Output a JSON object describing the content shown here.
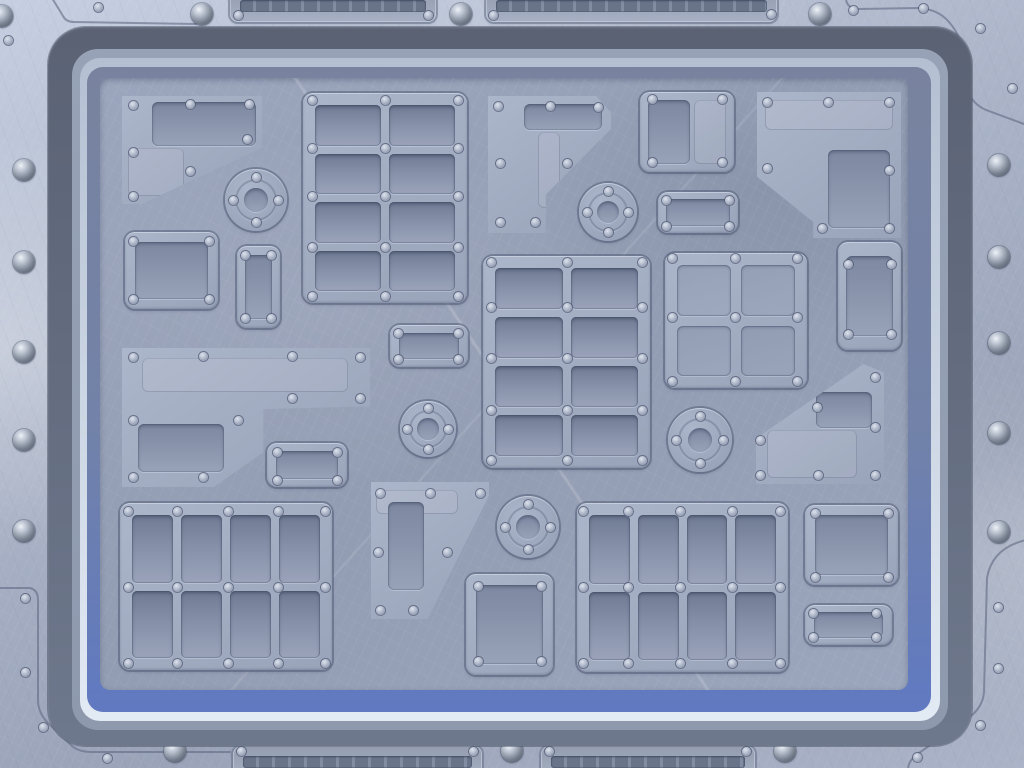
{
  "meta": {
    "description": "Sci-fi brushed-metal tech panel background: outer riveted steel frame with vent grilles and dome bolts, layered blue border rings, inner hull covered with riveted plates, vent grids and circular access ports",
    "width": 1024,
    "height": 768,
    "visible_text": "none"
  },
  "colors": {
    "metal_a": "#c6cfe1",
    "metal_b": "#aab3c7",
    "metal_c": "#9aa3b8",
    "ring_dark_a": "#5a6274",
    "ring_dark_b": "#6e788c",
    "ring_mid": "#8e99ae",
    "ring_light_a": "#b4c0d2",
    "ring_light_b": "#e2eaf4",
    "ring_blue_a": "#79839f",
    "ring_blue_b": "#6079c1",
    "panel_a": "#9ba5bc",
    "panel_b": "#929cb2",
    "plate_a": "#acb6ca",
    "plate_b": "#99a3b9",
    "inset_a": "#7d88a1",
    "inset_b": "#98a2b8",
    "cell_a": "#6f7a93",
    "cell_b": "#9aa3ba",
    "slat_a": "#6a7489",
    "slat_b": "#828da2",
    "rivet_a": "#dde4ee",
    "rivet_b": "#a6afc2",
    "rivet_c": "#7c869d",
    "rivet_edge": "rgba(80,90,115,0.75)",
    "dome_a": "#eef2f7",
    "dome_b": "#b9c1cf",
    "dome_c": "#78818f",
    "dome_d": "#565e6d",
    "line_dark": "rgba(86,96,122,0.55)",
    "line_light": "rgba(228,236,248,0.5)",
    "seam": "rgba(95,105,130,0.6)"
  },
  "scene": {
    "frame": {
      "domes": [
        [
          2,
          16
        ],
        [
          24,
          170
        ],
        [
          24,
          262
        ],
        [
          24,
          352
        ],
        [
          24,
          440
        ],
        [
          24,
          531
        ],
        [
          999,
          165
        ],
        [
          999,
          257
        ],
        [
          999,
          343
        ],
        [
          999,
          433
        ],
        [
          999,
          532
        ],
        [
          202,
          14
        ],
        [
          461,
          14
        ],
        [
          820,
          14
        ],
        [
          175,
          751
        ],
        [
          512,
          751
        ],
        [
          785,
          751
        ]
      ],
      "rivets": [
        [
          8,
          40
        ],
        [
          98,
          7
        ],
        [
          238,
          15
        ],
        [
          428,
          15
        ],
        [
          493,
          15
        ],
        [
          771,
          14
        ],
        [
          853,
          10
        ],
        [
          923,
          8
        ],
        [
          980,
          28
        ],
        [
          1012,
          88
        ],
        [
          25,
          598
        ],
        [
          25,
          672
        ],
        [
          43,
          727
        ],
        [
          107,
          758
        ],
        [
          241,
          751
        ],
        [
          473,
          751
        ],
        [
          549,
          751
        ],
        [
          746,
          751
        ],
        [
          998,
          607
        ],
        [
          998,
          668
        ],
        [
          980,
          725
        ],
        [
          917,
          757
        ]
      ],
      "grilles": [
        {
          "x": 230,
          "y": -10,
          "w": 206
        },
        {
          "x": 486,
          "y": -10,
          "w": 291
        },
        {
          "x": 233,
          "y": 746,
          "w": 249
        },
        {
          "x": 541,
          "y": 746,
          "w": 214
        }
      ],
      "seams": [
        "M 52 -2 L 63 16 Q 66 22 74 22 L 196 24",
        "M 846 -2 Q 846 8 858 9 L 918 8 Q 938 9 949 22 Q 962 37 964 56 L 966 82 Q 968 102 986 110 L 1024 124",
        "M -2 588 L 30 588 Q 38 590 38 600 L 38 700 Q 38 712 47 722 L 72 746 Q 79 752 92 752 L 230 752",
        "M 1026 540 Q 992 548 987 578 L 984 692 Q 983 706 971 716 L 919 753 Q 908 760 908 770"
      ]
    },
    "panel": {
      "plates": [
        {
          "name": "plate-top-left-angled",
          "x": 122,
          "y": 96,
          "w": 140,
          "h": 108,
          "clip": "polygon(0% 0%,100% 0%,100% 48%,14% 100%,0% 100%)",
          "kids": [
            {
              "t": "inset",
              "x": 30,
              "y": 6,
              "w": 104,
              "h": 44
            },
            {
              "t": "etch",
              "x": 6,
              "y": 52,
              "w": 56,
              "h": 48
            }
          ]
        },
        {
          "name": "plate-square-left",
          "x": 125,
          "y": 232,
          "w": 93,
          "h": 77,
          "kids": [
            {
              "t": "inset",
              "x": 10,
              "y": 10,
              "w": 73,
              "h": 57
            }
          ]
        },
        {
          "name": "plate-tall-small",
          "x": 237,
          "y": 246,
          "w": 43,
          "h": 82,
          "kids": [
            {
              "t": "inset",
              "x": 8,
              "y": 9,
              "w": 27,
              "h": 64
            }
          ]
        },
        {
          "name": "plate-l-shaped-left",
          "x": 122,
          "y": 348,
          "w": 248,
          "h": 139,
          "clip": "polygon(0% 0%,100% 0%,100% 42%,57% 44%,57% 75%,37% 100%,0% 100%)",
          "kids": [
            {
              "t": "etch",
              "x": 20,
              "y": 10,
              "w": 206,
              "h": 34
            },
            {
              "t": "inset",
              "x": 16,
              "y": 76,
              "w": 86,
              "h": 48
            }
          ]
        },
        {
          "name": "plate-small-wide-left",
          "x": 267,
          "y": 443,
          "w": 80,
          "h": 44,
          "kids": [
            {
              "t": "inset",
              "x": 9,
              "y": 8,
              "w": 62,
              "h": 28
            }
          ]
        },
        {
          "name": "plate-small-wide-center",
          "x": 390,
          "y": 325,
          "w": 78,
          "h": 42,
          "kids": [
            {
              "t": "inset",
              "x": 9,
              "y": 8,
              "w": 60,
              "h": 26
            }
          ]
        },
        {
          "name": "plate-pentagon-center",
          "x": 371,
          "y": 482,
          "w": 118,
          "h": 137,
          "clip": "polygon(0% 0%,100% 0%,100% 10%,48% 100%,0% 100%)",
          "kids": [
            {
              "t": "etch",
              "x": 5,
              "y": 8,
              "w": 82,
              "h": 24
            },
            {
              "t": "inset",
              "x": 17,
              "y": 20,
              "w": 36,
              "h": 88
            }
          ]
        },
        {
          "name": "plate-square-bottom-center",
          "x": 466,
          "y": 574,
          "w": 87,
          "h": 101,
          "kids": [
            {
              "t": "inset",
              "x": 10,
              "y": 11,
              "w": 67,
              "h": 79
            }
          ]
        },
        {
          "name": "plate-flag-top-center",
          "x": 488,
          "y": 96,
          "w": 123,
          "h": 137,
          "clip": "polygon(0% 0%,88% 0%,100% 12%,100% 24%,47% 72%,47% 100%,0% 100%)",
          "kids": [
            {
              "t": "inset",
              "x": 36,
              "y": 8,
              "w": 78,
              "h": 26
            },
            {
              "t": "etch",
              "x": 50,
              "y": 36,
              "w": 22,
              "h": 76
            }
          ]
        },
        {
          "name": "plate-top-right-small",
          "x": 640,
          "y": 92,
          "w": 94,
          "h": 80,
          "kids": [
            {
              "t": "inset",
              "x": 8,
              "y": 8,
              "w": 42,
              "h": 64
            },
            {
              "t": "etch",
              "x": 54,
              "y": 8,
              "w": 32,
              "h": 64
            }
          ]
        },
        {
          "name": "plate-small-wide-right",
          "x": 658,
          "y": 192,
          "w": 80,
          "h": 41,
          "kids": [
            {
              "t": "inset",
              "x": 8,
              "y": 7,
              "w": 64,
              "h": 27
            }
          ]
        },
        {
          "name": "panel-angular-top-right",
          "x": 757,
          "y": 92,
          "w": 144,
          "h": 146,
          "clip": "polygon(0% 0%,100% 0%,100% 100%,39% 100%,39% 89%,0% 58%)",
          "kids": [
            {
              "t": "etch",
              "x": 8,
              "y": 8,
              "w": 128,
              "h": 30
            },
            {
              "t": "inset",
              "x": 71,
              "y": 58,
              "w": 62,
              "h": 78
            }
          ]
        },
        {
          "name": "plate-tall-right",
          "x": 838,
          "y": 242,
          "w": 63,
          "h": 108,
          "kids": [
            {
              "t": "inset",
              "x": 8,
              "y": 14,
              "w": 47,
              "h": 80
            }
          ]
        },
        {
          "name": "panel-angular-bottom-right",
          "x": 756,
          "y": 364,
          "w": 128,
          "h": 120,
          "clip": "polygon(84% 0%,100% 7%,100% 100%,0% 100%,0% 62%)",
          "kids": [
            {
              "t": "etch",
              "x": 11,
              "y": 66,
              "w": 90,
              "h": 48
            },
            {
              "t": "inset",
              "x": 60,
              "y": 28,
              "w": 56,
              "h": 36
            }
          ]
        },
        {
          "name": "plate-square-bottom-right",
          "x": 805,
          "y": 505,
          "w": 93,
          "h": 80,
          "kids": [
            {
              "t": "inset",
              "x": 10,
              "y": 10,
              "w": 73,
              "h": 60
            }
          ]
        },
        {
          "name": "plate-small-wide-bottom-right",
          "x": 805,
          "y": 605,
          "w": 87,
          "h": 40,
          "kids": [
            {
              "t": "inset",
              "x": 9,
              "y": 7,
              "w": 69,
              "h": 26
            }
          ]
        }
      ],
      "vents": [
        {
          "name": "vent-grid-top-center",
          "x": 303,
          "y": 93,
          "w": 164,
          "h": 210,
          "cols": 2,
          "rows": 4,
          "rivet_xs": [
            312,
            385,
            458
          ],
          "rivet_ys": [
            100,
            148,
            196,
            247,
            296
          ]
        },
        {
          "name": "vent-grid-center",
          "x": 483,
          "y": 256,
          "w": 167,
          "h": 212,
          "cols": 2,
          "rows": 4,
          "rivet_xs": [
            491,
            567,
            642
          ],
          "rivet_ys": [
            262,
            307,
            358,
            410,
            460
          ]
        },
        {
          "name": "vent-grid-bottom-left",
          "x": 120,
          "y": 503,
          "w": 212,
          "h": 167,
          "cols": 4,
          "rows": 2,
          "rivet_xs": [
            128,
            177,
            228,
            278,
            325
          ],
          "rivet_ys": [
            511,
            587,
            663
          ]
        },
        {
          "name": "vent-grid-bottom-center",
          "x": 577,
          "y": 503,
          "w": 211,
          "h": 169,
          "cols": 4,
          "rows": 2,
          "rivet_xs": [
            583,
            628,
            680,
            732,
            780
          ],
          "rivet_ys": [
            511,
            587,
            663
          ]
        },
        {
          "name": "grid-2x2-right",
          "x": 665,
          "y": 253,
          "w": 142,
          "h": 135,
          "cols": 2,
          "rows": 2,
          "flat": true,
          "rivet_xs": [
            672,
            735,
            797
          ],
          "rivet_ys": [
            258,
            317,
            381
          ]
        }
      ],
      "ports": [
        {
          "cx": 256,
          "cy": 200,
          "r": 31
        },
        {
          "cx": 608,
          "cy": 212,
          "r": 29
        },
        {
          "cx": 428,
          "cy": 429,
          "r": 28
        },
        {
          "cx": 700,
          "cy": 440,
          "r": 32
        },
        {
          "cx": 528,
          "cy": 527,
          "r": 31
        }
      ],
      "rivets": [
        [
          133,
          105
        ],
        [
          190,
          104
        ],
        [
          249,
          104
        ],
        [
          133,
          152
        ],
        [
          133,
          196
        ],
        [
          247,
          139
        ],
        [
          190,
          171
        ],
        [
          133,
          241
        ],
        [
          209,
          241
        ],
        [
          133,
          299
        ],
        [
          209,
          299
        ],
        [
          245,
          255
        ],
        [
          271,
          255
        ],
        [
          245,
          318
        ],
        [
          271,
          318
        ],
        [
          133,
          357
        ],
        [
          203,
          356
        ],
        [
          292,
          356
        ],
        [
          360,
          357
        ],
        [
          133,
          420
        ],
        [
          133,
          477
        ],
        [
          203,
          477
        ],
        [
          238,
          420
        ],
        [
          292,
          398
        ],
        [
          360,
          398
        ],
        [
          277,
          452
        ],
        [
          337,
          452
        ],
        [
          277,
          480
        ],
        [
          337,
          480
        ],
        [
          398,
          333
        ],
        [
          458,
          333
        ],
        [
          398,
          359
        ],
        [
          458,
          359
        ],
        [
          498,
          106
        ],
        [
          550,
          106
        ],
        [
          598,
          107
        ],
        [
          500,
          163
        ],
        [
          567,
          163
        ],
        [
          500,
          222
        ],
        [
          535,
          222
        ],
        [
          652,
          99
        ],
        [
          722,
          99
        ],
        [
          652,
          162
        ],
        [
          722,
          162
        ],
        [
          666,
          200
        ],
        [
          729,
          200
        ],
        [
          666,
          226
        ],
        [
          729,
          226
        ],
        [
          767,
          102
        ],
        [
          828,
          102
        ],
        [
          889,
          102
        ],
        [
          889,
          170
        ],
        [
          889,
          228
        ],
        [
          822,
          228
        ],
        [
          767,
          168
        ],
        [
          848,
          264
        ],
        [
          891,
          264
        ],
        [
          848,
          334
        ],
        [
          891,
          334
        ],
        [
          875,
          377
        ],
        [
          817,
          407
        ],
        [
          875,
          427
        ],
        [
          760,
          440
        ],
        [
          760,
          475
        ],
        [
          818,
          475
        ],
        [
          875,
          475
        ],
        [
          380,
          493
        ],
        [
          430,
          493
        ],
        [
          480,
          493
        ],
        [
          378,
          552
        ],
        [
          447,
          552
        ],
        [
          380,
          610
        ],
        [
          413,
          610
        ],
        [
          478,
          586
        ],
        [
          541,
          586
        ],
        [
          478,
          661
        ],
        [
          541,
          661
        ],
        [
          815,
          513
        ],
        [
          888,
          513
        ],
        [
          815,
          577
        ],
        [
          888,
          577
        ],
        [
          813,
          613
        ],
        [
          876,
          613
        ],
        [
          813,
          637
        ],
        [
          876,
          637
        ]
      ]
    }
  }
}
